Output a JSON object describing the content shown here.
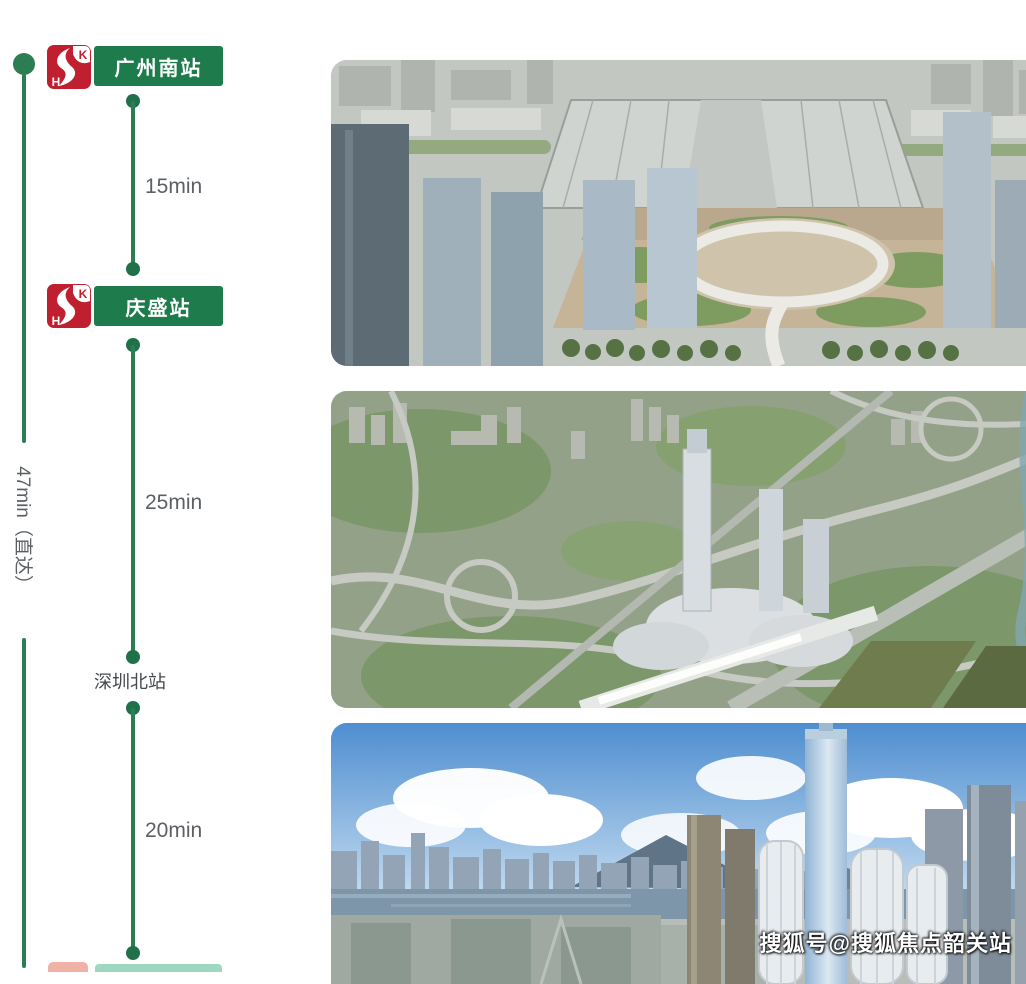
{
  "route": {
    "direct_label": "47min（直达）",
    "stations": [
      {
        "name": "广州南站"
      },
      {
        "name": "庆盛站"
      },
      {
        "name": "深圳北站"
      }
    ],
    "segments": [
      {
        "duration": "15min"
      },
      {
        "duration": "25min"
      },
      {
        "duration": "20min"
      }
    ],
    "badge": {
      "s": "S",
      "k": "K",
      "h": "H"
    }
  },
  "images": [
    {
      "description": "Aerial rendering of Qingsheng high-speed-rail station hub with landscaped podium, loop road and glass towers"
    },
    {
      "description": "Aerial rendering of station district with highway interchanges, central skyscraper and elevated rail viaduct"
    },
    {
      "description": "Hong Kong skyline over Victoria Harbour with ICC tower and West Kowloon high-rises under cumulus clouds"
    }
  ],
  "watermark": {
    "text": "搜狐号@搜狐焦点韶关站"
  },
  "colors": {
    "station_green": "#1e7b4b",
    "line_green": "#2c7d52",
    "dot_green": "#20704a",
    "badge_red": "#bf1f2e",
    "time_text_gray": "#5c6065"
  }
}
